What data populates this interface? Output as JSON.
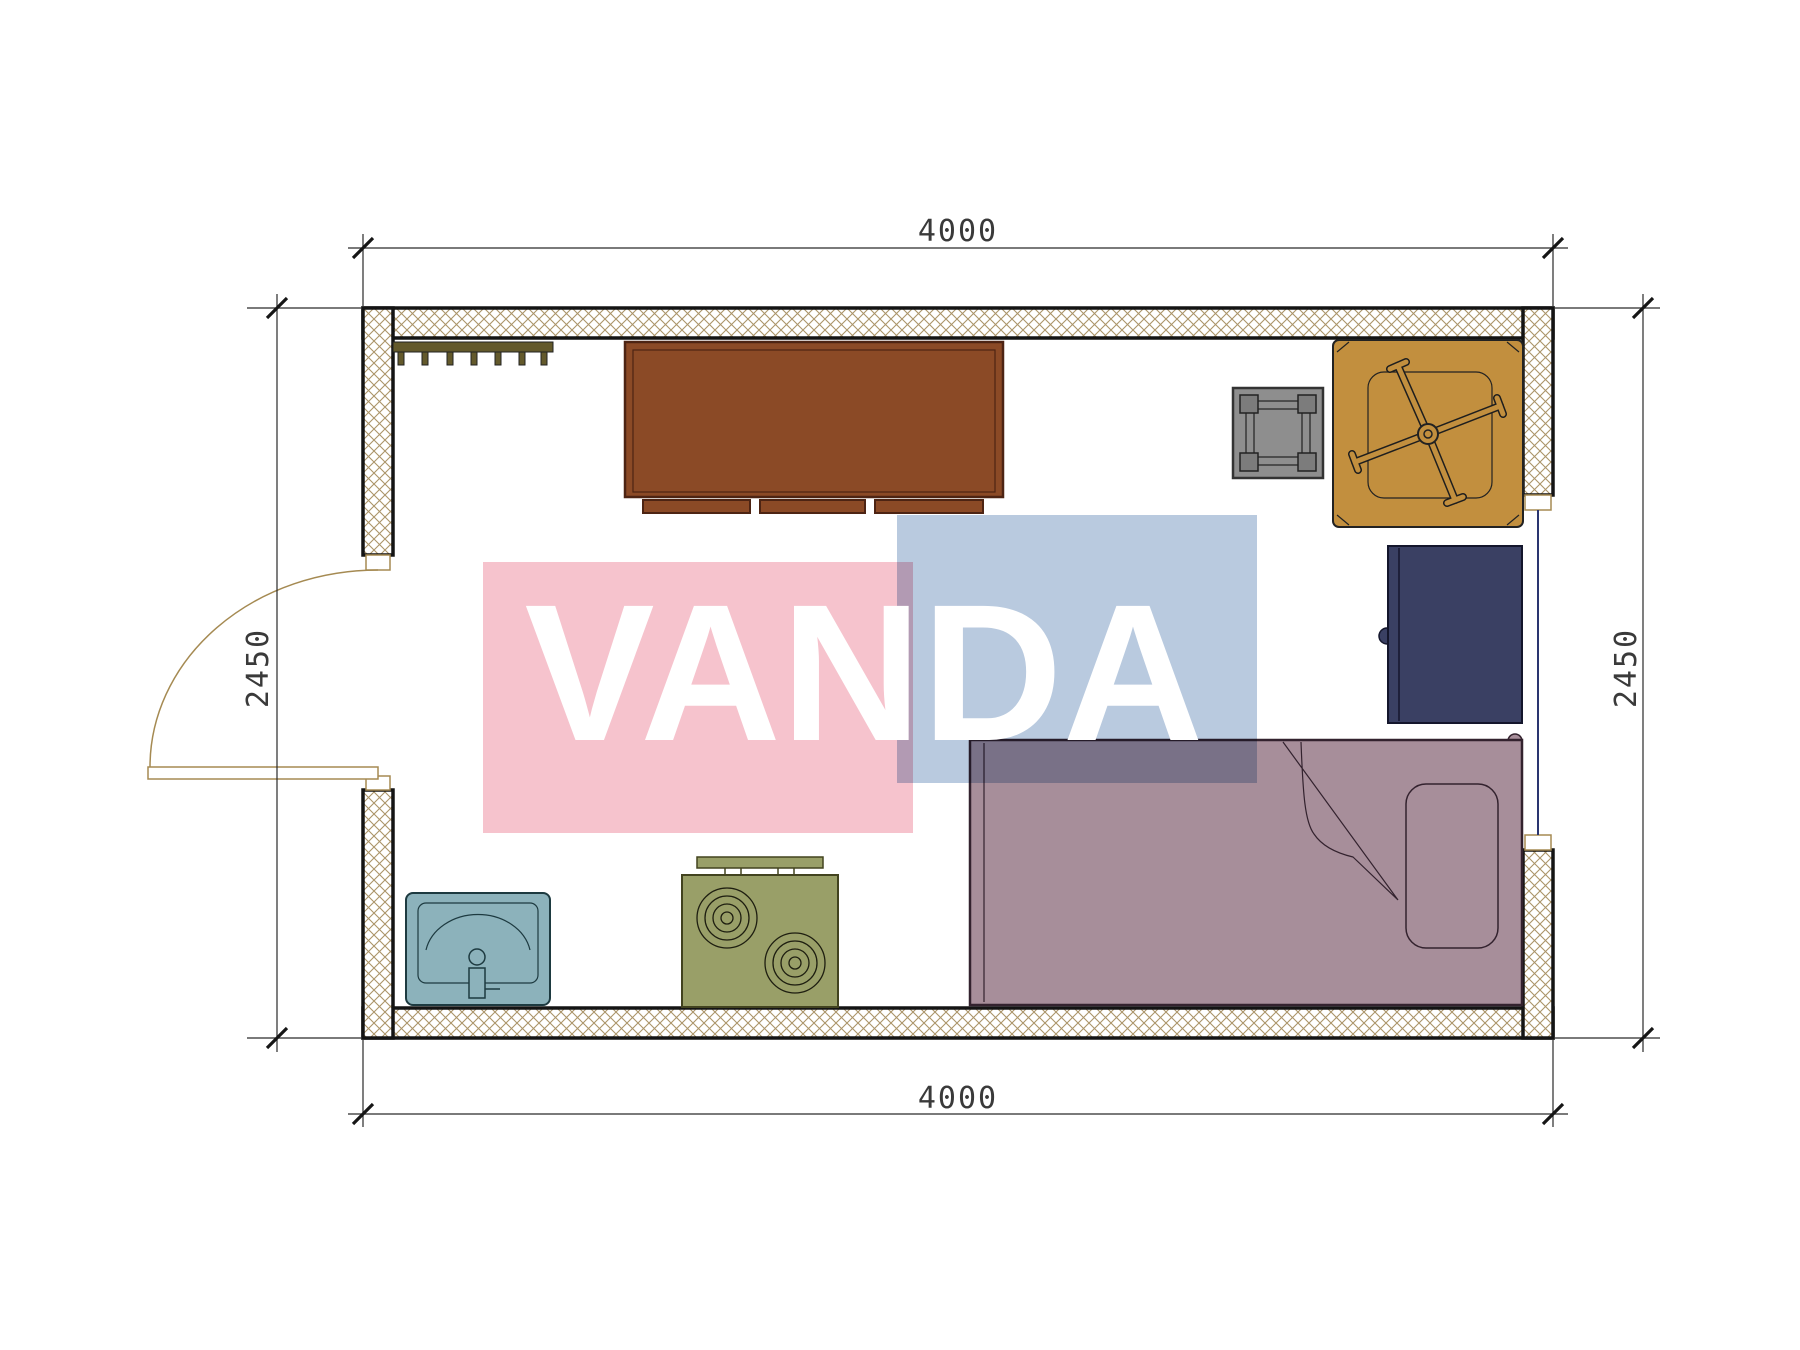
{
  "watermark": {
    "text": "VANDA",
    "pink": "#f6c3cd",
    "blue": "#b9cadf",
    "text_color": "#ffffff"
  },
  "dimensions": {
    "top": "4000",
    "bottom": "4000",
    "left": "2450",
    "right": "2450"
  },
  "plan": {
    "background": "#ffffff",
    "wall_hatch_color": "#ab9468",
    "wall_border_color": "#141414",
    "dim_line_color": "#2a2a2a",
    "door_color": "#a58a52",
    "window_color": "#2a3570",
    "colors": {
      "coat_rack": "#63592b",
      "desk": "#8b4a26",
      "desk_border": "#4d2413",
      "stool": "#8e8e8e",
      "stool_leg": "#7c7c7c",
      "table": "#c28f3e",
      "cabinet": "#3a4063",
      "bed": "#a78e9a",
      "bed_border": "#33222e",
      "sink": "#8cb2bb",
      "sink_border": "#1d3a40",
      "stove": "#999f68",
      "stove_border": "#42431f"
    }
  }
}
